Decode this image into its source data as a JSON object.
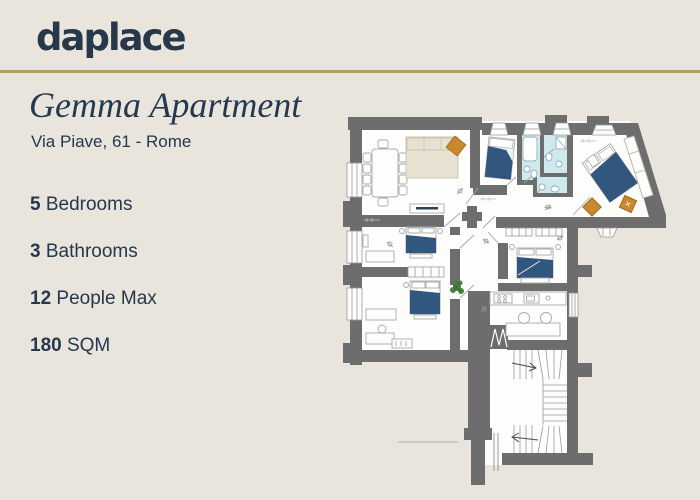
{
  "page": {
    "background_color": "#e9e5dc",
    "accent_gold": "#b49c61",
    "text_navy": "#243850"
  },
  "header": {
    "logo_text": "daplace"
  },
  "listing": {
    "title": "Gemma Apartment",
    "address": "Via Piave, 61 - Rome",
    "specs": [
      {
        "value": "5",
        "label": "Bedrooms"
      },
      {
        "value": "3",
        "label": "Bathrooms"
      },
      {
        "value": "12",
        "label": "People Max"
      },
      {
        "value": "180",
        "label": "SQM"
      }
    ]
  },
  "floor_plan": {
    "type": "apartment-floor-plan",
    "rooms_depicted": [
      "living-dining room",
      "bedroom",
      "bedroom",
      "bedroom",
      "bedroom",
      "bedroom",
      "bathroom",
      "bathroom",
      "bathroom",
      "kitchen",
      "corridor",
      "staircase",
      "entrance hall"
    ],
    "colors": {
      "walls": "#6d6d6d",
      "floor": "#fdfdfc",
      "bathroom_floor": "#cfeaee",
      "beds": "#32577e",
      "accent_furniture": "#c9882d",
      "sofa_beige": "#e7e1d1",
      "plant_green": "#47823f"
    }
  }
}
